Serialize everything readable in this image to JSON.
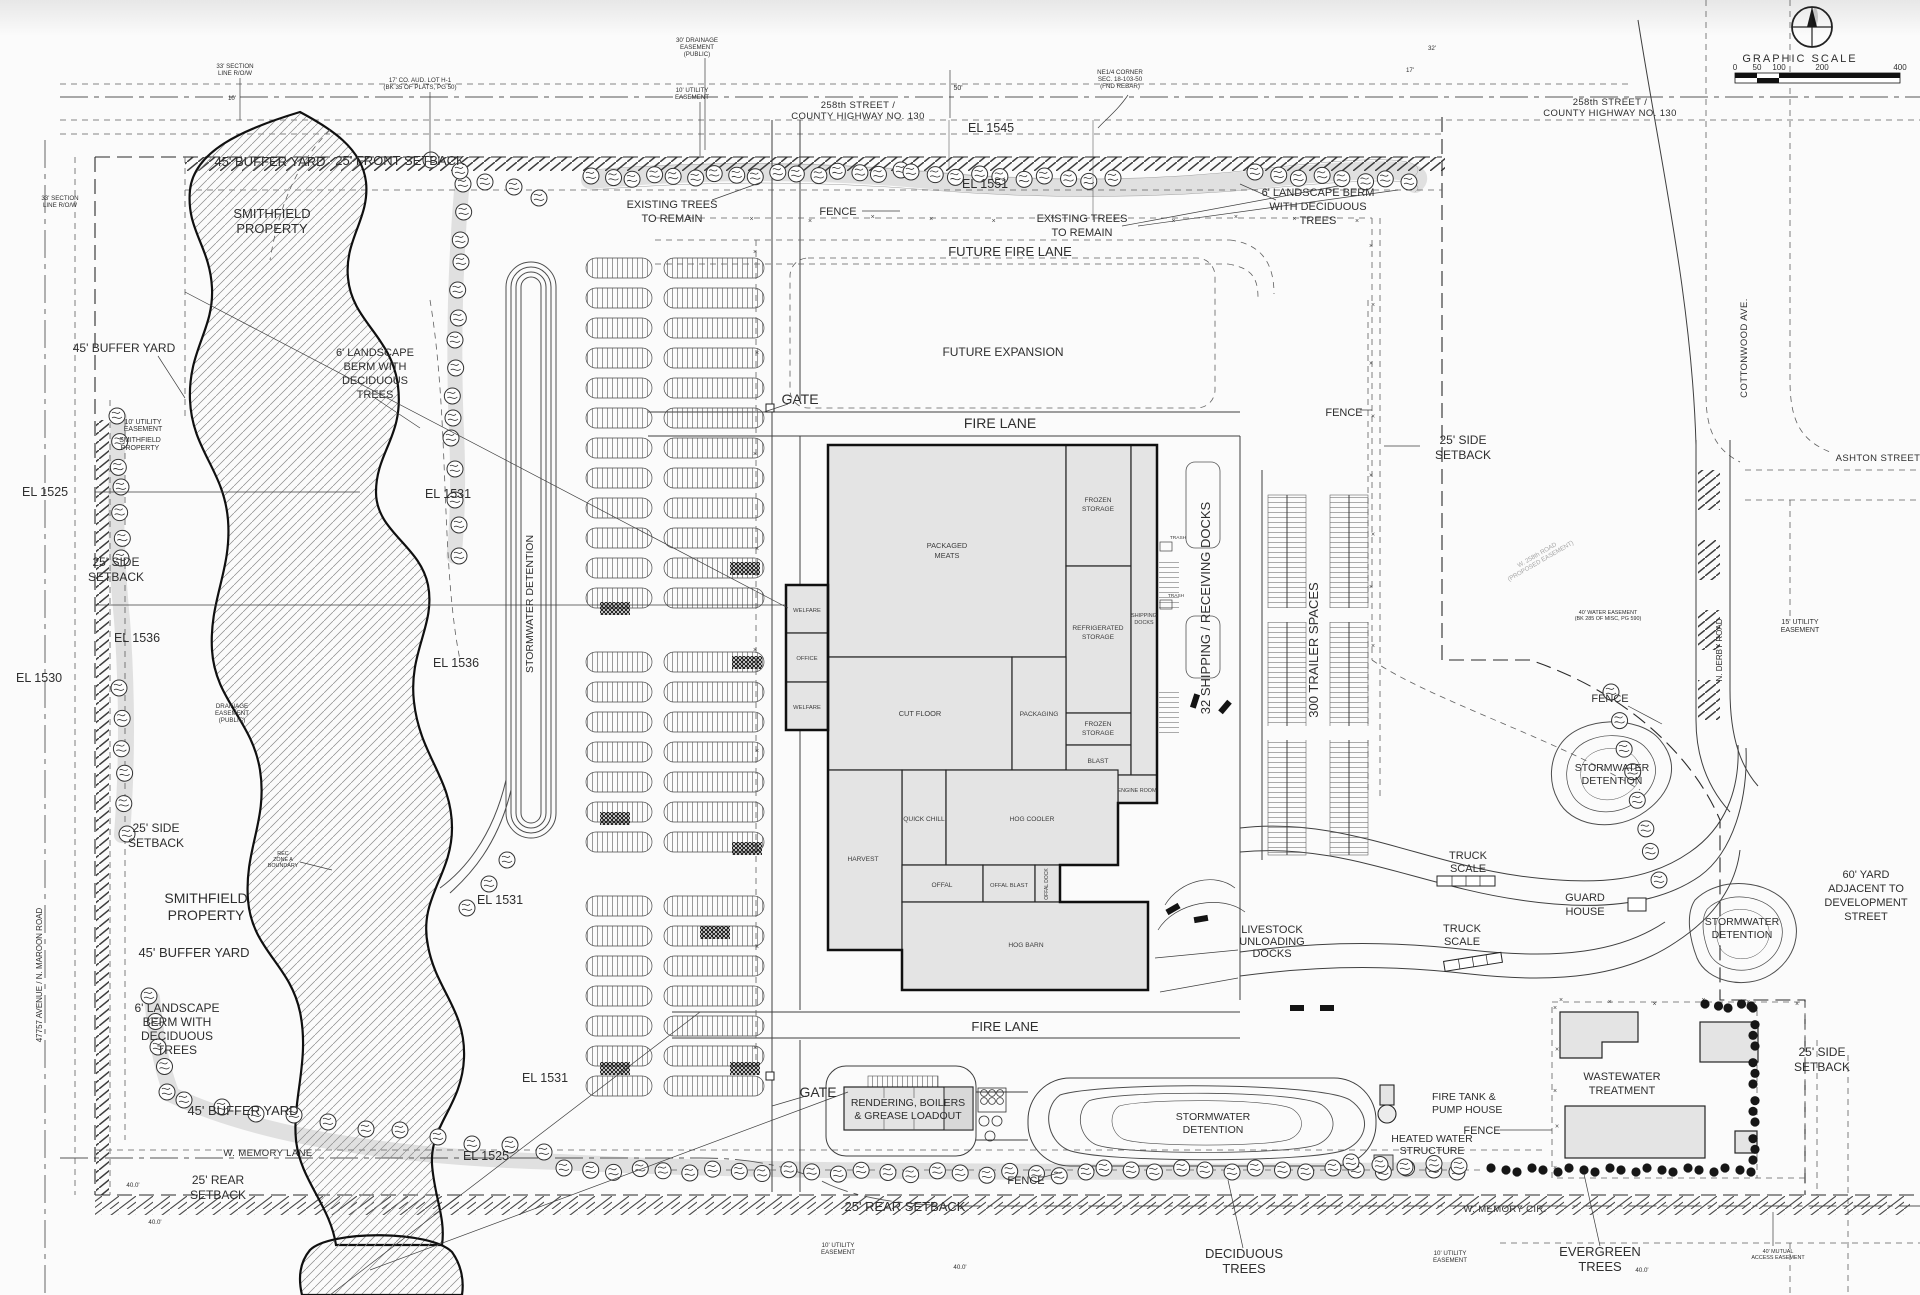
{
  "drawing": {
    "scale": {
      "title": "GRAPHIC SCALE",
      "ticks": [
        "0",
        "50",
        "100",
        "200",
        "400"
      ]
    },
    "streets": {
      "street_258": [
        "258th STREET /",
        "COUNTY HIGHWAY NO. 130"
      ],
      "ashton": "ASHTON STREET",
      "cottonwood": "COTTONWOOD AVE.",
      "n_derby": "N. DERBY ROAD",
      "w_memory_lane": "W. MEMORY LANE",
      "w_memory_cir": "W. MEMORY CIR.",
      "ave_47757": "47757 AVENUE / N. MAROON ROAD",
      "w258_proposed": [
        "W. 258th ROAD",
        "(PROPOSED EASEMENT)"
      ]
    },
    "elev": {
      "el1545": "EL 1545",
      "el1551": "EL 1551",
      "el1525": "EL 1525",
      "el1530": "EL 1530",
      "el1531": "EL 1531",
      "el1536": "EL 1536"
    },
    "site": {
      "buffer45": "45' BUFFER YARD",
      "front25": "25' FRONT SETBACK",
      "side25": [
        "25' SIDE",
        "SETBACK"
      ],
      "rear25": "25' REAR SETBACK",
      "rear25b": [
        "25' REAR",
        "SETBACK"
      ],
      "smithfield": [
        "SMITHFIELD",
        "PROPERTY"
      ],
      "berm3": [
        "6' LANDSCAPE BERM",
        "WITH DECIDUOUS",
        "TREES"
      ],
      "berm4": [
        "6' LANDSCAPE",
        "BERM WITH",
        "DECIDUOUS",
        "TREES"
      ],
      "existing_trees": [
        "EXISTING TREES",
        "TO REMAIN"
      ],
      "fence": "FENCE",
      "gate": "GATE",
      "fire_lane": "FIRE LANE",
      "future_fire_lane": "FUTURE FIRE LANE",
      "future_expansion": "FUTURE EXPANSION",
      "stormwater": [
        "STORMWATER",
        "DETENTION"
      ],
      "stormwater1": "STORMWATER DETENTION",
      "docks32": "32 SHIPPING / RECEIVING DOCKS",
      "trailers300": "300 TRAILER SPACES",
      "truck_scale": [
        "TRUCK",
        "SCALE"
      ],
      "guard_house": [
        "GUARD",
        "HOUSE"
      ],
      "livestock": [
        "LIVESTOCK",
        "UNLOADING",
        "DOCKS"
      ],
      "yard60": [
        "60' YARD",
        "ADJACENT TO",
        "DEVELOPMENT",
        "STREET"
      ],
      "wastewater": [
        "WASTEWATER",
        "TREATMENT"
      ],
      "fire_tank": [
        "FIRE TANK &",
        "PUMP HOUSE"
      ],
      "heated_water": [
        "HEATED WATER",
        "STRUCTURE"
      ],
      "rendering": [
        "RENDERING, BOILERS",
        "& GREASE LOADOUT"
      ],
      "deciduous": [
        "DECIDUOUS",
        "TREES"
      ],
      "evergreen": [
        "EVERGREEN",
        "TREES"
      ]
    },
    "building": {
      "packaged_meats": [
        "PACKAGED",
        "MEATS"
      ],
      "frozen": [
        "FROZEN",
        "STORAGE"
      ],
      "refrigerated": [
        "REFRIGERATED",
        "STORAGE"
      ],
      "blast": "BLAST",
      "shipping": [
        "SHIPPING",
        "DOCKS"
      ],
      "engine": "ENGINE ROOM",
      "cut_floor": "CUT FLOOR",
      "packaging": "PACKAGING",
      "quick_chill": "QUICK CHILL",
      "hog_cooler": "HOG COOLER",
      "harvest": "HARVEST",
      "offal": "OFFAL",
      "offal_blast": "OFFAL BLAST",
      "offal_dock": "OFFAL DOCK",
      "hog_barn": "HOG BARN",
      "welfare": "WELFARE",
      "office": "OFFICE",
      "trash": "TRASH"
    },
    "ease": {
      "sect33": [
        "33' SECTION",
        "LINE R/O/W"
      ],
      "aud17": [
        "17' CO. AUD. LOT H-1",
        "(BK 35 OF PLATS, PG 50)"
      ],
      "drain30": [
        "30' DRAINAGE",
        "EASEMENT",
        "(PUBLIC)"
      ],
      "util10": [
        "10' UTILITY",
        "EASEMENT"
      ],
      "ne_corner": [
        "NE1/4 CORNER",
        "SEC. 18-103-50",
        "(FND REBAR)"
      ],
      "drain_pub": [
        "DRAINAGE",
        "EASEMENT",
        "(PUBLIC)"
      ],
      "rec_zone": [
        "REC",
        "ZONE A",
        "BOUNDARY"
      ],
      "util15": [
        "15' UTILITY",
        "EASEMENT"
      ],
      "water40": [
        "40' WATER EASEMENT",
        "(BK 285 OF MISC, PG 590)"
      ],
      "mutual40": [
        "40' MUTUAL",
        "ACCESS EASEMENT"
      ],
      "dim50": "50'",
      "dim40": "40.0'",
      "dim32": "32'",
      "dim17": "17'",
      "dim10": "10'"
    }
  },
  "colors": {
    "paper": "#fbfbfb",
    "line": "#3f3f3f",
    "building_fill": "#e4e4e4",
    "heavy": "#161616"
  }
}
